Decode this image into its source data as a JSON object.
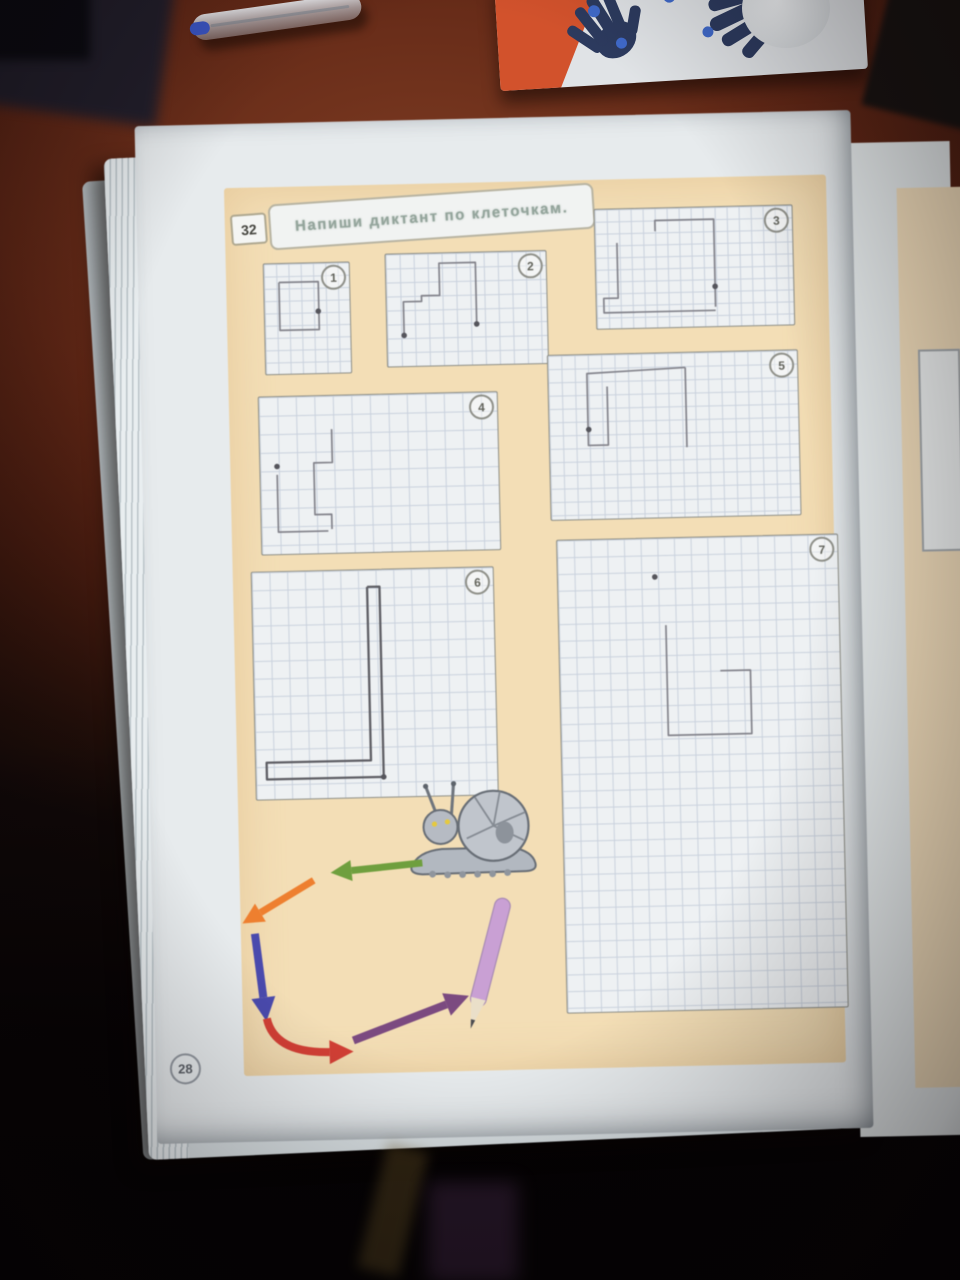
{
  "header": {
    "task_number": "32",
    "title": "Напиши диктант по клеточкам."
  },
  "footer": {
    "page_number": "28"
  },
  "boxes": [
    {
      "id": 1,
      "label": "1",
      "x": 37,
      "y": 76,
      "w": 85,
      "h": 110,
      "cell": 12.3,
      "lines": [
        [
          [
            1.2,
            1.5
          ],
          [
            4.4,
            1.5
          ],
          [
            4.4,
            5.4
          ],
          [
            1.2,
            5.4
          ],
          [
            1.2,
            1.5
          ]
        ]
      ],
      "dots": [
        [
          4.35,
          3.9
        ]
      ]
    },
    {
      "id": 2,
      "label": "2",
      "x": 159,
      "y": 69,
      "w": 160,
      "h": 112,
      "cell": 14,
      "lines": [
        [
          [
            1.2,
            5.8
          ],
          [
            1.2,
            3.4
          ],
          [
            2.5,
            3.4
          ],
          [
            2.5,
            3.0
          ],
          [
            3.8,
            3.0
          ],
          [
            3.8,
            0.7
          ],
          [
            6.4,
            0.7
          ],
          [
            6.4,
            5.1
          ]
        ]
      ],
      "dots": [
        [
          1.2,
          5.8
        ],
        [
          6.4,
          5.1
        ]
      ]
    },
    {
      "id": 3,
      "label": "3",
      "x": 369,
      "y": 29,
      "w": 197,
      "h": 119,
      "cell": 12,
      "lines": [
        [
          [
            5.0,
            1.9
          ],
          [
            5.0,
            1.0
          ],
          [
            9.9,
            1.0
          ],
          [
            9.9,
            8.3
          ]
        ],
        [
          [
            1.8,
            2.8
          ],
          [
            1.8,
            7.4
          ],
          [
            0.6,
            7.4
          ],
          [
            0.6,
            8.6
          ],
          [
            9.9,
            8.6
          ]
        ]
      ],
      "dots": [
        [
          9.9,
          6.6
        ]
      ]
    },
    {
      "id": 4,
      "label": "4",
      "x": 29,
      "y": 209,
      "w": 238,
      "h": 157,
      "cell": 18.5,
      "lines": [
        [
          [
            3.9,
            1.8
          ],
          [
            3.9,
            3.6
          ],
          [
            2.9,
            3.6
          ],
          [
            2.9,
            6.4
          ],
          [
            3.8,
            6.4
          ],
          [
            3.8,
            7.2
          ]
        ],
        [
          [
            0.9,
            4.2
          ],
          [
            0.9,
            7.3
          ],
          [
            3.6,
            7.3
          ]
        ]
      ],
      "dots": [
        [
          0.9,
          3.75
        ]
      ]
    },
    {
      "id": 5,
      "label": "5",
      "x": 319,
      "y": 174,
      "w": 249,
      "h": 164,
      "cell": 13.3,
      "lines": [
        [
          [
            10.3,
            1.1
          ],
          [
            2.9,
            1.4
          ],
          [
            2.9,
            6.8
          ],
          [
            4.4,
            6.8
          ],
          [
            4.4,
            2.4
          ]
        ],
        [
          [
            10.3,
            1.1
          ],
          [
            10.3,
            7.1
          ]
        ]
      ],
      "dots": [
        [
          2.95,
          5.6
        ]
      ]
    },
    {
      "id": 6,
      "label": "6",
      "x": 18,
      "y": 384,
      "w": 241,
      "h": 227,
      "cell": 17.7,
      "stroke": "#5e5e64",
      "strokeWidth": 2.3,
      "lines": [
        [
          [
            6.5,
            0.95
          ],
          [
            7.2,
            0.95
          ],
          [
            7.2,
            11.7
          ],
          [
            0.6,
            11.7
          ],
          [
            0.6,
            10.75
          ],
          [
            6.5,
            10.75
          ],
          [
            6.5,
            0.95
          ]
        ]
      ],
      "dots": [
        [
          7.2,
          11.7
        ]
      ]
    },
    {
      "id": 7,
      "label": "7",
      "x": 324,
      "y": 359,
      "w": 280,
      "h": 472,
      "cell": 16.7,
      "lines": [
        [
          [
            6.4,
            5.2
          ],
          [
            6.4,
            11.8
          ],
          [
            11.4,
            11.8
          ],
          [
            11.4,
            8.0
          ],
          [
            9.6,
            8.0
          ]
        ]
      ],
      "dots": [
        [
          5.8,
          2.3
        ]
      ]
    }
  ],
  "route": {
    "arrows": [
      {
        "name": "green-left-arrow",
        "color": "#6f9f3e",
        "width": 7,
        "pts": [
          [
            183,
            679
          ],
          [
            112,
            685
          ]
        ]
      },
      {
        "name": "orange-downleft-arrow",
        "color": "#ee7f2f",
        "width": 7,
        "pts": [
          [
            74,
            694
          ],
          [
            20,
            725
          ]
        ]
      },
      {
        "name": "blue-down-arrow",
        "color": "#4a4aad",
        "width": 8,
        "pts": [
          [
            14,
            746
          ],
          [
            21,
            810
          ]
        ]
      },
      {
        "name": "red-curve-arrow",
        "color": "#d23f35",
        "width": 8,
        "pts": [
          [
            24,
            831
          ],
          [
            31,
            866
          ],
          [
            86,
            866
          ]
        ]
      },
      {
        "name": "purple-upright-arrow",
        "color": "#7b4a80",
        "width": 8,
        "pts": [
          [
            110,
            855
          ],
          [
            204,
            821
          ]
        ]
      }
    ],
    "pencil": {
      "body": "#c9a0d4",
      "outline": "#a98cb5",
      "wood": "#eadfc9",
      "lead": "#4c4c50"
    }
  }
}
